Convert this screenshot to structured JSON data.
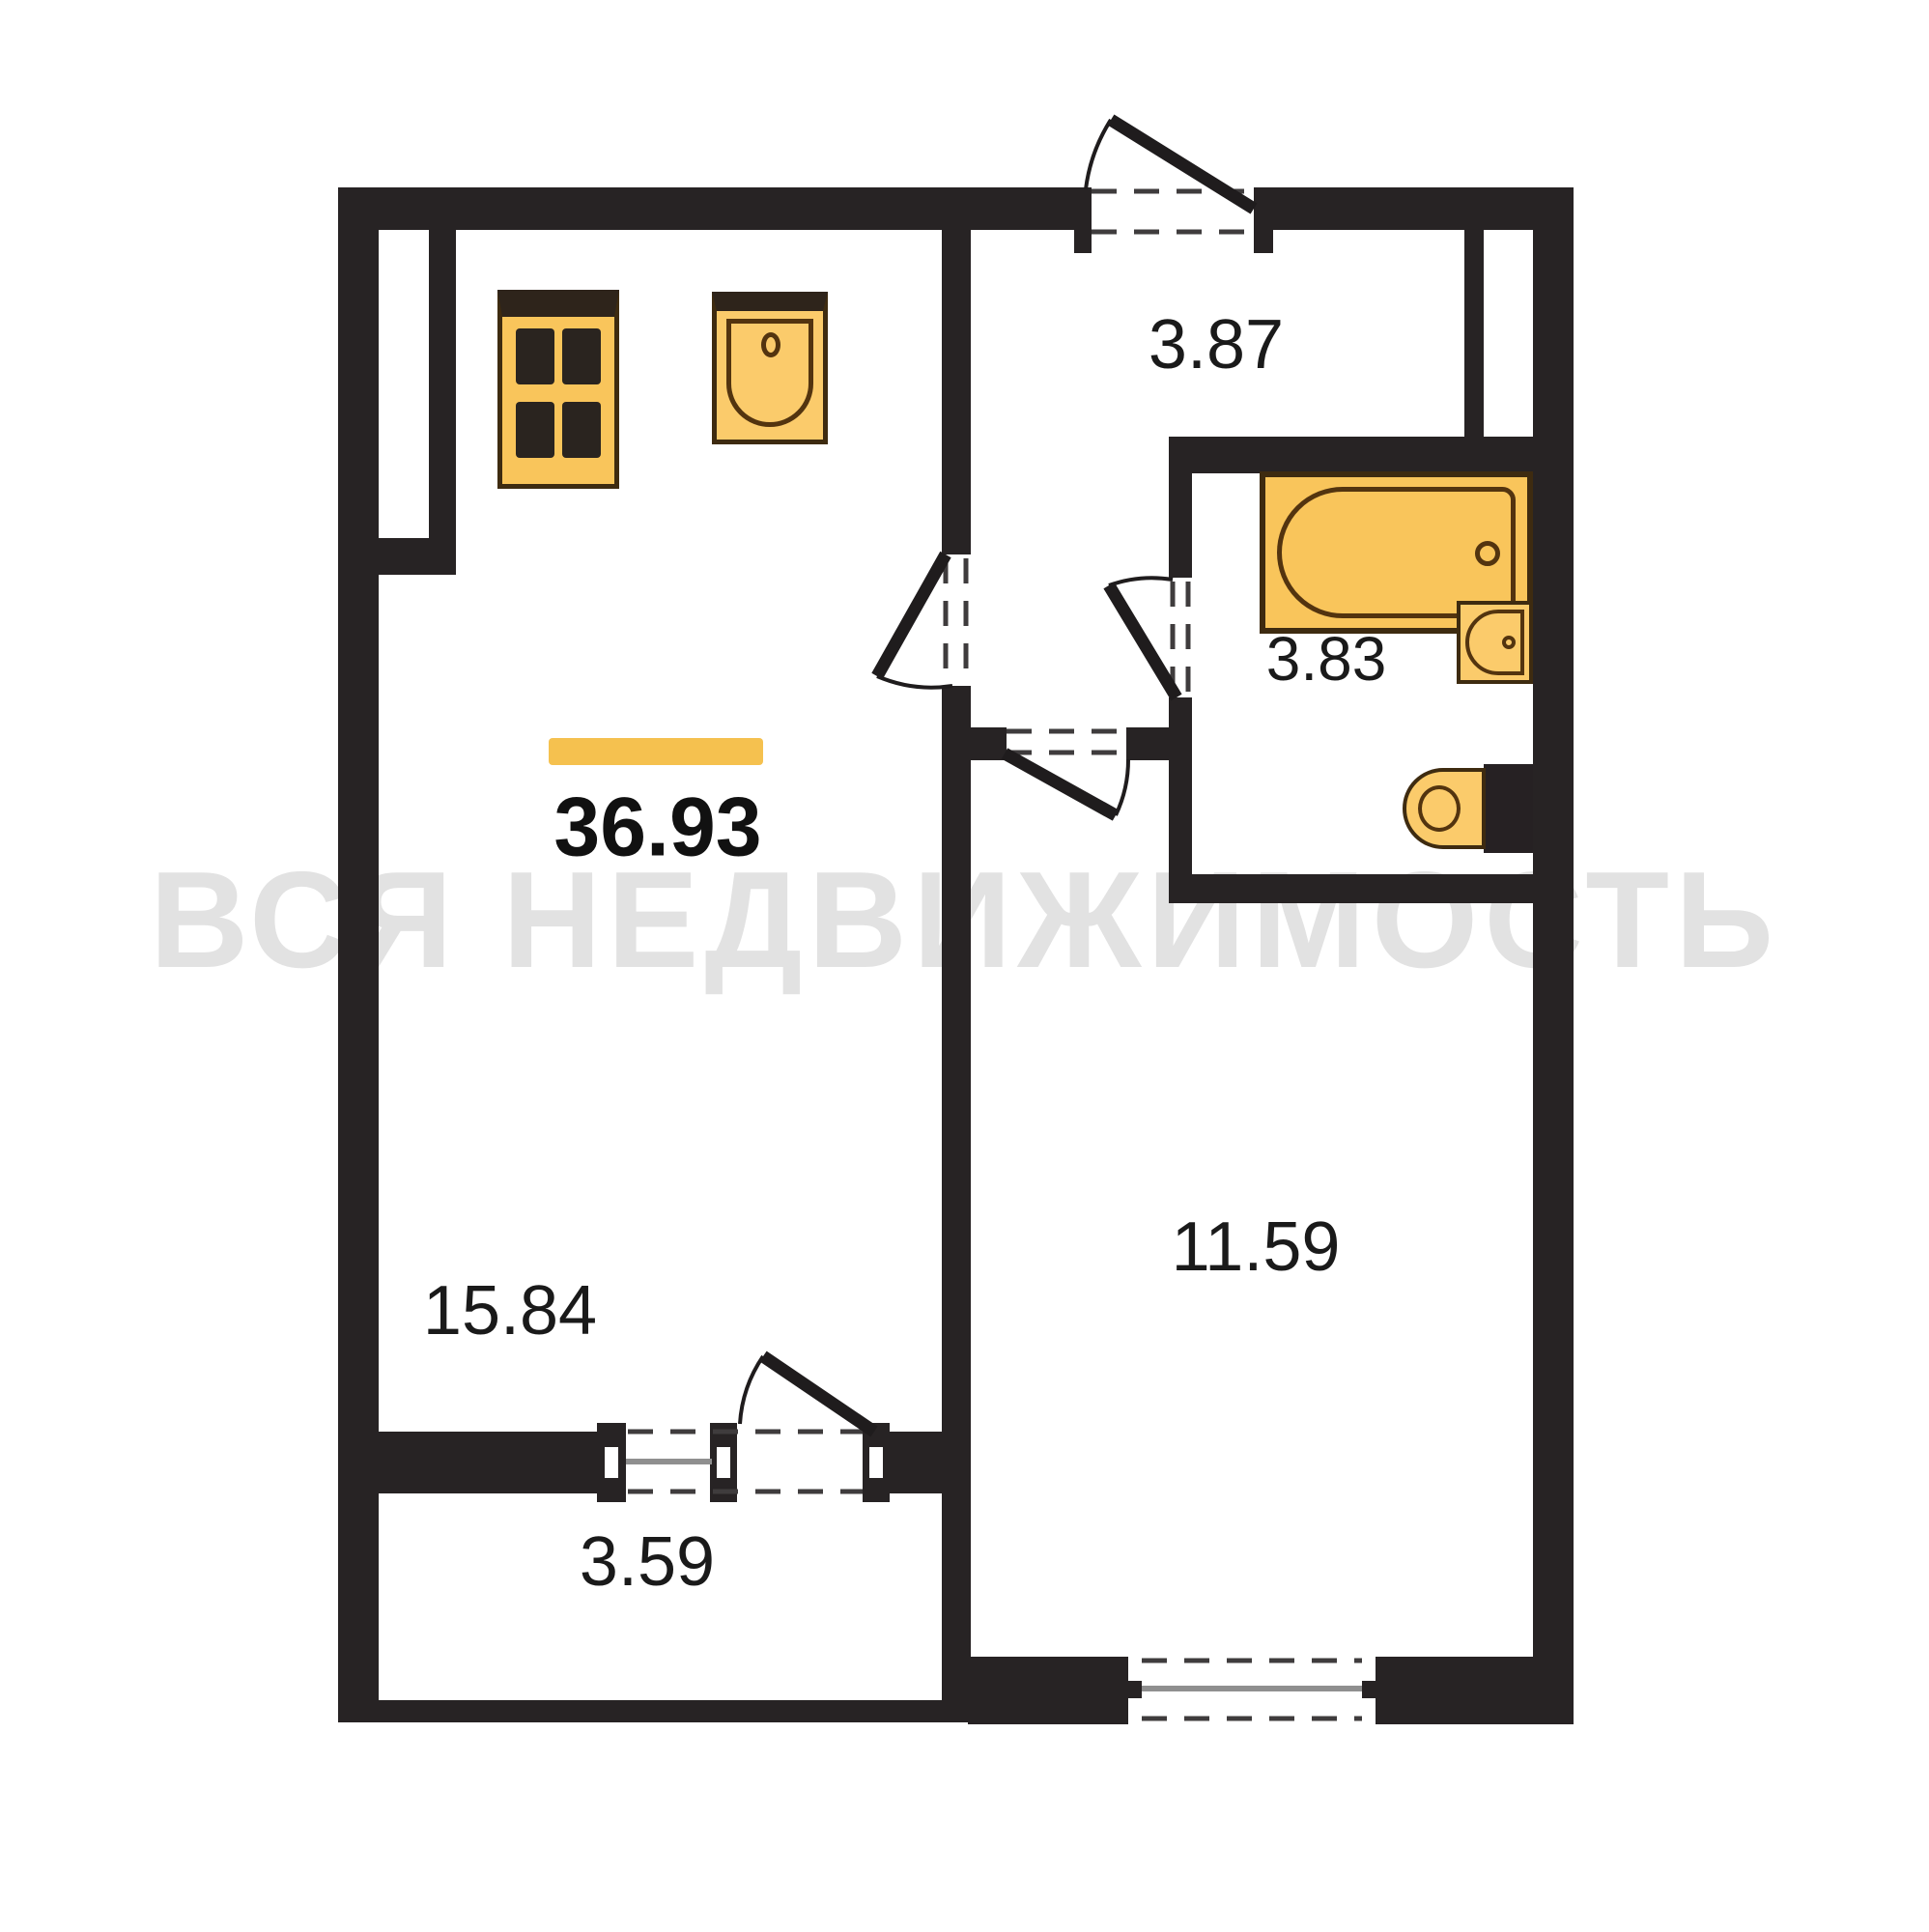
{
  "watermark_text": "ВСЯ НЕДВИЖИМОСТЬ",
  "total_area": "36.93",
  "rooms": {
    "kitchen_living": {
      "name": "kitchen-living-room",
      "area": "15.84"
    },
    "hall": {
      "name": "entrance-hall",
      "area": "3.87"
    },
    "bathroom": {
      "name": "bathroom",
      "area": "3.83"
    },
    "bedroom": {
      "name": "bedroom",
      "area": "11.59"
    },
    "balcony": {
      "name": "balcony",
      "area": "3.59"
    }
  },
  "icons": {
    "stove": "stove-icon",
    "kitchen_sink": "kitchen-sink-icon",
    "bathtub": "bathtub-icon",
    "bathroom_sink": "bathroom-sink-icon",
    "toilet": "toilet-icon"
  },
  "colors": {
    "wall": "#272324",
    "leaf": "#1f1c1d",
    "dash": "#3f3c3d",
    "glass": "#8f8f8f",
    "fixture_fill": "#F9C55B",
    "fixture_fill_light": "#FBCB6B",
    "fixture_border": "#3E2B10",
    "fixture_inner": "#53340F",
    "fixture_top": "#2E241B",
    "bar": "#F5C14F",
    "watermark": "#e2e2e2",
    "label": "#1a1a1a",
    "bg": "#ffffff"
  }
}
